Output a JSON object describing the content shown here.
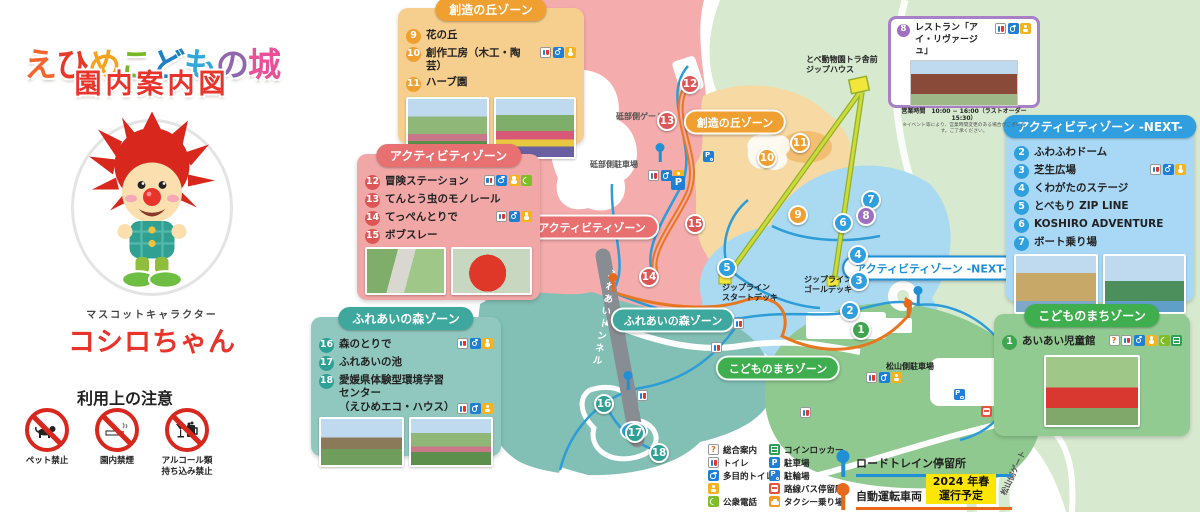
{
  "title": {
    "chars": [
      {
        "ch": "え",
        "color": "#F2652F"
      },
      {
        "ch": "ひ",
        "color": "#E73828"
      },
      {
        "ch": "め",
        "color": "#F5A21D"
      },
      {
        "ch": "こ",
        "color": "#76B82A"
      },
      {
        "ch": "ど",
        "color": "#1E7FC2"
      },
      {
        "ch": "も",
        "color": "#2FA8DC"
      },
      {
        "ch": "の",
        "color": "#9067AC"
      },
      {
        "ch": "城",
        "color": "#E95098"
      }
    ],
    "subtitle": "園内案内図"
  },
  "mascot": {
    "caption": "マスコットキャラクター",
    "name": "コシロちゃん"
  },
  "notices": {
    "heading": "利用上の注意",
    "items": [
      {
        "icon": "no-pets-icon",
        "label": "ペット禁止"
      },
      {
        "icon": "no-smoking-icon",
        "label": "園内禁煙"
      },
      {
        "icon": "no-alcohol-icon",
        "label": "アルコール類\n持ち込み禁止"
      }
    ]
  },
  "zones": {
    "souzou": {
      "title": "創造の丘ゾーン",
      "items": [
        {
          "num": "9",
          "label": "花の丘"
        },
        {
          "num": "10",
          "label": "創作工房（木工・陶芸）",
          "icons": [
            "toilet",
            "wheelchair",
            "baby"
          ]
        },
        {
          "num": "11",
          "label": "ハーブ園"
        }
      ]
    },
    "activity": {
      "title": "アクティビティゾーン",
      "items": [
        {
          "num": "12",
          "label": "冒険ステーション",
          "icons": [
            "toilet",
            "wheelchair",
            "baby",
            "phone"
          ]
        },
        {
          "num": "13",
          "label": "てんとう虫のモノレール"
        },
        {
          "num": "14",
          "label": "てっぺんとりで",
          "icons": [
            "toilet",
            "wheelchair",
            "baby"
          ]
        },
        {
          "num": "15",
          "label": "ボブスレー"
        }
      ]
    },
    "fureai": {
      "title": "ふれあいの森ゾーン",
      "items": [
        {
          "num": "16",
          "label": "森のとりで",
          "icons": [
            "toilet",
            "wheelchair",
            "baby"
          ]
        },
        {
          "num": "17",
          "label": "ふれあいの池"
        },
        {
          "num": "18",
          "label": "愛媛県体験型環境学習センター\n（えひめエコ・ハウス）",
          "icons": [
            "toilet",
            "wheelchair",
            "baby"
          ]
        }
      ]
    },
    "next": {
      "title": "アクティビティゾーン -NEXT-",
      "items": [
        {
          "num": "2",
          "label": "ふわふわドーム"
        },
        {
          "num": "3",
          "label": "芝生広場",
          "icons": [
            "toilet",
            "wheelchair",
            "baby"
          ]
        },
        {
          "num": "4",
          "label": "くわがたのステージ"
        },
        {
          "num": "5",
          "label": "とべもり ZIP LINE"
        },
        {
          "num": "6",
          "label": "KOSHIRO ADVENTURE"
        },
        {
          "num": "7",
          "label": "ボート乗り場"
        }
      ]
    },
    "machi": {
      "title": "こどものまちゾーン",
      "items": [
        {
          "num": "1",
          "label": "あいあい児童館",
          "icons": [
            "info",
            "toilet",
            "wheelchair",
            "baby",
            "phone",
            "locker"
          ]
        }
      ]
    }
  },
  "restaurant": {
    "num": "8",
    "label": "レストラン「アイ・リヴァージュ」",
    "icons": [
      "toilet",
      "wheelchair",
      "baby"
    ],
    "hours": "営業時間　10:00 − 16:00（ラストオーダー 15:30）",
    "note": "※イベント等により、営業時間変更のある場合がございます。ご了承ください。"
  },
  "map": {
    "pills": {
      "souzou": "創造の丘ゾーン",
      "activity": "アクティビティゾーン",
      "fureai": "ふれあいの森ゾーン",
      "machi": "こどものまちゾーン",
      "next": "アクティビティゾーン -NEXT-"
    },
    "labels": {
      "tobe_gate": "砥部側ゲート",
      "tobe_parking": "砥部側駐車場",
      "zip_house": "とべ動物園トラ舎前\nジップハウス",
      "zip_start": "ジップライン\nスタートデッキ",
      "zip_goal": "ジップライン\nゴールデッキ",
      "matsuyama_parking": "松山側駐車場",
      "matsuyama_gate": "松山側ゲート",
      "tunnel": "ふれあいトンネル"
    },
    "markers": [
      {
        "num": "1",
        "color": "#3FA64F",
        "x": 861,
        "y": 330
      },
      {
        "num": "2",
        "color": "#2F9FDD",
        "x": 850,
        "y": 311
      },
      {
        "num": "3",
        "color": "#2F9FDD",
        "x": 859,
        "y": 281
      },
      {
        "num": "4",
        "color": "#2F9FDD",
        "x": 858,
        "y": 255
      },
      {
        "num": "5",
        "color": "#2F9FDD",
        "x": 727,
        "y": 268
      },
      {
        "num": "6",
        "color": "#2F9FDD",
        "x": 843,
        "y": 223
      },
      {
        "num": "7",
        "color": "#2F9FDD",
        "x": 871,
        "y": 200
      },
      {
        "num": "8",
        "color": "#A06FC0",
        "x": 866,
        "y": 216
      },
      {
        "num": "9",
        "color": "#F0A030",
        "x": 798,
        "y": 215
      },
      {
        "num": "10",
        "color": "#F0A030",
        "x": 767,
        "y": 158
      },
      {
        "num": "11",
        "color": "#F0A030",
        "x": 800,
        "y": 143
      },
      {
        "num": "12",
        "color": "#DD5656",
        "x": 690,
        "y": 84
      },
      {
        "num": "13",
        "color": "#DD5656",
        "x": 667,
        "y": 121
      },
      {
        "num": "14",
        "color": "#DD5656",
        "x": 649,
        "y": 277
      },
      {
        "num": "15",
        "color": "#DD5656",
        "x": 695,
        "y": 224
      },
      {
        "num": "16",
        "color": "#2FA096",
        "x": 604,
        "y": 404
      },
      {
        "num": "17",
        "color": "#2FA096",
        "x": 635,
        "y": 433
      },
      {
        "num": "18",
        "color": "#2FA096",
        "x": 659,
        "y": 453
      }
    ]
  },
  "legend": {
    "facilities": [
      {
        "icon": "info",
        "label": "総合案内"
      },
      {
        "icon": "toilet",
        "label": "トイレ"
      },
      {
        "icon": "wheelchair",
        "label": "多目的トイレ"
      },
      {
        "icon": "baby",
        "label": ""
      },
      {
        "icon": "phone",
        "label": "公衆電話"
      },
      {
        "icon": "locker",
        "label": "コインロッカー"
      },
      {
        "icon": "parking",
        "label": "駐車場"
      },
      {
        "icon": "bike",
        "label": "駐輪場"
      },
      {
        "icon": "bus",
        "label": "路線バス停留所"
      },
      {
        "icon": "taxi",
        "label": "タクシー乗り場"
      }
    ],
    "stops": [
      {
        "color": "#1F8FD6",
        "label": "ロードトレイン停留所"
      },
      {
        "color": "#E8681C",
        "label": "自動運転車両　停留所"
      }
    ],
    "badge": "2024 年春\n運行予定"
  }
}
